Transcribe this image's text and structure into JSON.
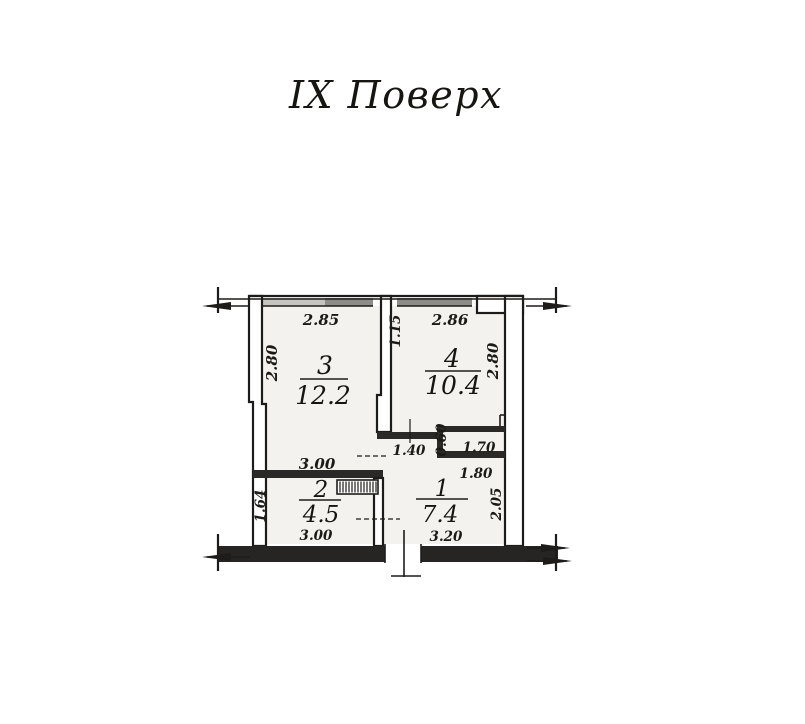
{
  "title": "IX Поверх",
  "floor_plan": {
    "rooms": [
      {
        "number": "3",
        "area": "12.2"
      },
      {
        "number": "4",
        "area": "10.4"
      },
      {
        "number": "2",
        "area": "4.5"
      },
      {
        "number": "1",
        "area": "7.4"
      }
    ],
    "dimensions": {
      "top_left_width": "2.85",
      "top_partition_offset": "1.15",
      "top_right_width": "2.86",
      "left_wall_height": "2.80",
      "right_wall_height": "2.80",
      "room3_bottom_width": "3.00",
      "corridor_door_width": "1.40",
      "niche_depth": "0.60",
      "niche_width": "1.70",
      "room1_top_width": "1.80",
      "room1_height": "2.05",
      "room2_height": "1.64",
      "room2_bottom_width": "3.00",
      "room1_bottom_width": "3.20"
    }
  },
  "colors": {
    "ink": "#1d1c1a",
    "room_fill": "#f4f2ef",
    "window_light": "#c6c4c0",
    "window_dark": "#8e8c88",
    "wall_dark": "#2a2927",
    "bottom_wall": "#262523"
  }
}
